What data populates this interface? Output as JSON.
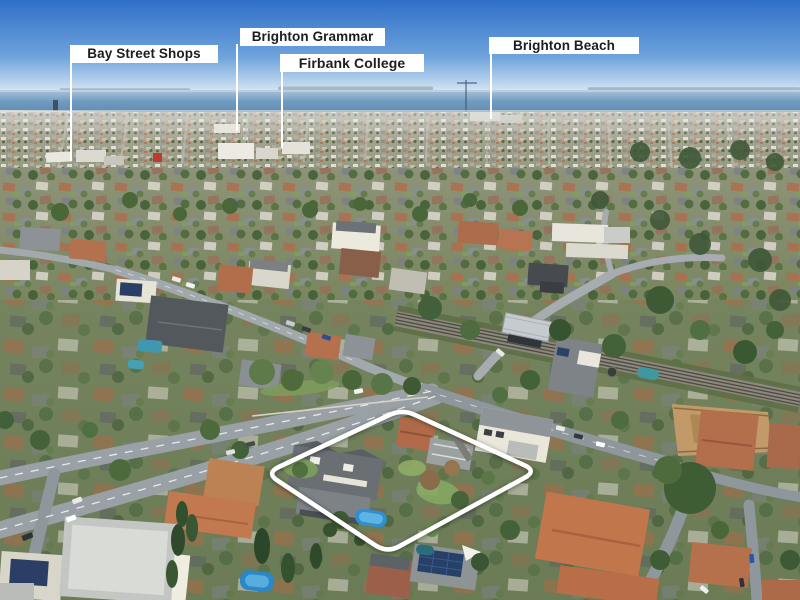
{
  "photo": {
    "description": "Aerial drone photo of bayside suburb (Brighton) with sea horizon, rail corridor and highlighted property boundary",
    "annotations": {
      "labels": [
        {
          "text": "Bay Street Shops"
        },
        {
          "text": "Brighton Grammar"
        },
        {
          "text": "Firbank College"
        },
        {
          "text": "Brighton Beach"
        }
      ]
    },
    "property_outline": {
      "stroke": "#ffffff"
    },
    "palette": {
      "sky_top": "#2f6fc8",
      "sky_mid": "#6fa3dc",
      "sky_horizon": "#d6e6f3",
      "sea_top": "#a9c4d6",
      "sea_mid": "#6e9ac0",
      "sea_deep": "#57809f",
      "shore_sand": "#d7d2c2",
      "label_bg": "#ffffff",
      "label_text": "#1d1d1f",
      "pool_blue": "#2f8fd0",
      "roof_terracotta": "#b56f4e",
      "roof_slate": "#5f6569",
      "tree_green": "#4d6a3c",
      "road_gray": "#99a1a6",
      "rail_ballast": "#8b887c",
      "dirt_site": "#c29a6a"
    }
  }
}
